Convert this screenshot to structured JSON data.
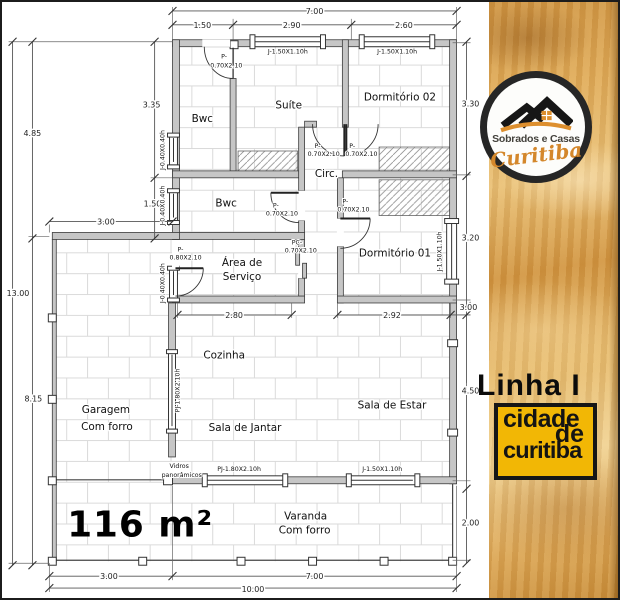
{
  "sidebar": {
    "logo": {
      "line1": "Sobrados e Casas",
      "line2": "Curitiba"
    },
    "series_label": "Linha I",
    "badge": {
      "line1": "cidade",
      "line2": "de",
      "line3": "curitiba"
    },
    "colors": {
      "wood": "#DCA95F",
      "badge_bg": "#F2B705",
      "badge_text": "#141414",
      "logo_orange": "#DD8F2E",
      "logo_dark": "#262626"
    }
  },
  "plan": {
    "area_label": "116 m²",
    "rooms": {
      "bwc1": "Bwc",
      "suite": "Suíte",
      "dorm02": "Dormitório 02",
      "circ": "Circ.",
      "bwc2": "Bwc",
      "dorm01": "Dormitório 01",
      "servico_l1": "Área de",
      "servico_l2": "Serviço",
      "cozinha": "Cozinha",
      "garagem_l1": "Garagem",
      "garagem_l2": "Com forro",
      "jantar": "Sala de Jantar",
      "estar": "Sala de Estar",
      "varanda_l1": "Varanda",
      "varanda_l2": "Com forro"
    },
    "dims": {
      "top_total": "7.00",
      "top_1": "1.50",
      "top_2": "2.90",
      "top_3": "2.60",
      "left_total": "13.00",
      "left_upper": "4.85",
      "left_lower": "8.15",
      "left_bwc": "3.35",
      "left_bwc2": "1.50",
      "garage_width": "3.00",
      "right_1": "3.30",
      "right_2": "3.20",
      "right_3": "3.00",
      "right_4": "4.50",
      "right_5": "2.00",
      "servico_width": "2.80",
      "dorm01_width": "2.92",
      "bottom_1": "3.00",
      "bottom_2": "7.00",
      "bottom_total": "10.00"
    },
    "openings": {
      "door_p_prefix": "P-",
      "door_p70_size": "0.70X2.10",
      "door_p80_size": "0.80X2.10",
      "door_pc_prefix": "PC-",
      "window_j150": "J-1.50X1.10h",
      "window_pj180": "PJ-1.80X2.10h",
      "window_j040": "J-0.40X0.40h"
    },
    "notes": {
      "glass_l1": "Vidros",
      "glass_l2": "panorâmicos"
    }
  }
}
